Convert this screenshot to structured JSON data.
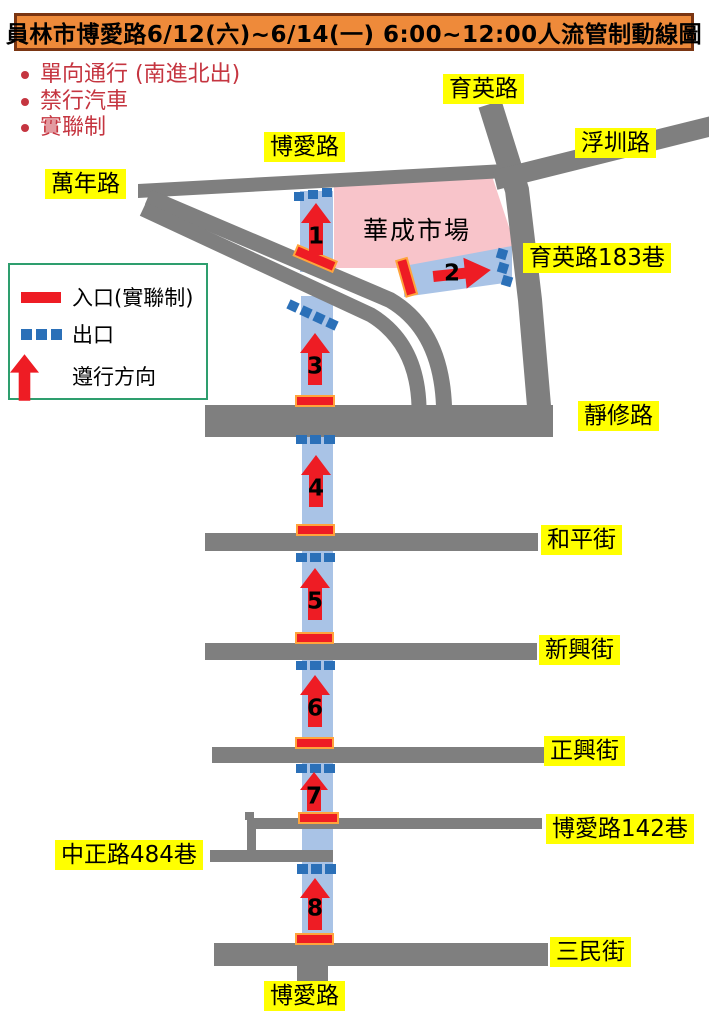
{
  "title": "員林市博愛路6/12(六)~6/14(一) 6:00~12:00人流管制動線圖",
  "notes": {
    "n1": "單向通行 (南進北出)",
    "n2": "禁行汽車",
    "n3": "實聯制"
  },
  "legend": {
    "entrance": "入口(實聯制)",
    "exit": "出口",
    "direction": "遵行方向"
  },
  "labels": {
    "yuying": "育英路",
    "fuzhen": "浮圳路",
    "boai_top": "博愛路",
    "wannian": "萬年路",
    "yuying183": "育英路183巷",
    "jingxiu": "靜修路",
    "heping": "和平街",
    "xinxing": "新興街",
    "zhengxing": "正興街",
    "boai142": "博愛路142巷",
    "zhongzheng484": "中正路484巷",
    "sanmin": "三民街",
    "boai_bottom": "博愛路"
  },
  "market": "華成市場",
  "route_numbers": {
    "s1": "1",
    "s2": "2",
    "s3": "3",
    "s4": "4",
    "s5": "5",
    "s6": "6",
    "s7": "7",
    "s8": "8"
  },
  "colors": {
    "title-bg": "#ee8a3a",
    "title-border": "#7a3512",
    "note-red": "#c53540",
    "label-bg": "#ffff00",
    "road-gray": "#7f7f7f",
    "route-blue": "#a9c3e6",
    "exit-blue": "#2b70b8",
    "sign-red": "#ee1c24",
    "sign-outline": "#ffa43c",
    "market-pink": "#f8c4ca",
    "legend-green": "#2e9e6e"
  }
}
